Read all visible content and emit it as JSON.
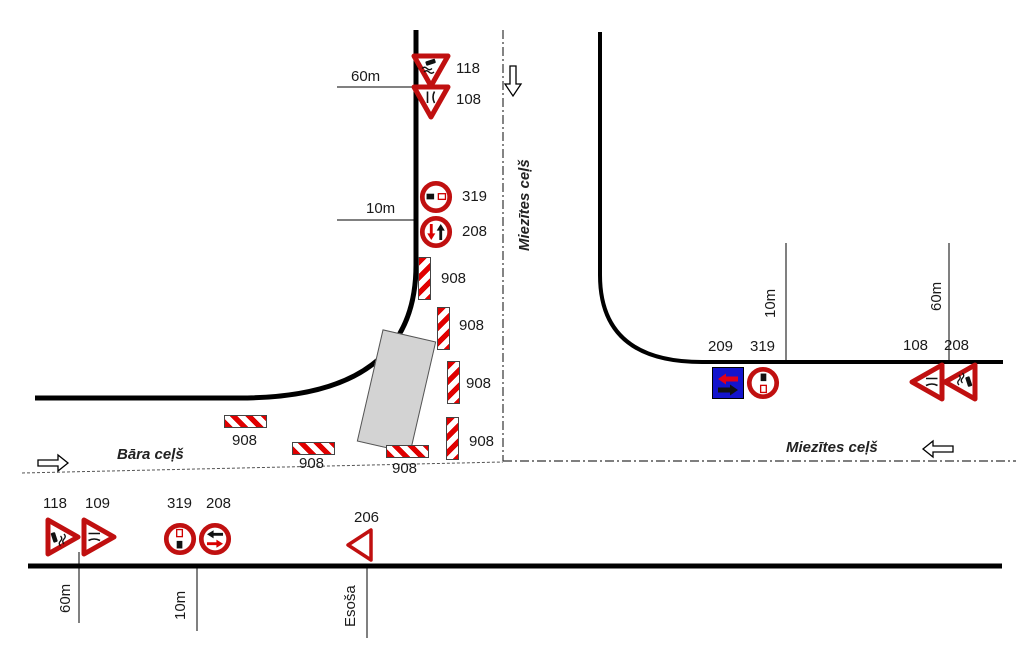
{
  "colors": {
    "sign_red": "#c01010",
    "stripe_red": "#e00000",
    "arrow_red": "#e00018",
    "sign_blue": "#1414cc",
    "work_zone_gray": "#d3d3d3",
    "road_black": "#000000"
  },
  "roads": {
    "miezites_vertical_label": "Miezītes ceļš",
    "miezites_horizontal_label": "Miezītes ceļš",
    "bara_label": "Bāra ceļš",
    "existing_label": "Esoša"
  },
  "distances": {
    "top_60m": "60m",
    "top_10m": "10m",
    "right_10m": "10m",
    "right_60m": "60m",
    "bottom_60m": "60m",
    "bottom_10m": "10m"
  },
  "signs": {
    "top": {
      "s118": "118",
      "s108": "108",
      "s319": "319",
      "s208": "208"
    },
    "right": {
      "s209": "209",
      "s319": "319",
      "s108": "108",
      "s208": "208"
    },
    "bottom": {
      "s118": "118",
      "s109": "109",
      "s319": "319",
      "s208": "208",
      "s206": "206"
    },
    "barrier_label": "908"
  }
}
